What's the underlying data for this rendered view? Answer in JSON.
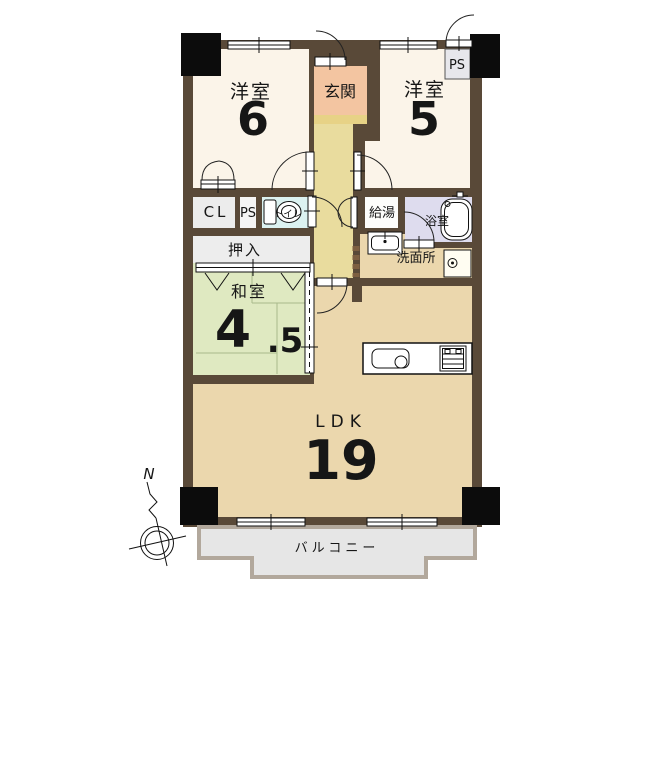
{
  "rooms": {
    "western6": {
      "name": "洋室",
      "size": "6"
    },
    "entrance": {
      "name": "玄関"
    },
    "western5": {
      "name": "洋室",
      "size": "5"
    },
    "ps_top": {
      "name": "PS"
    },
    "closet_cl": {
      "name": "CL"
    },
    "ps_mid": {
      "name": "PS"
    },
    "toilet": {
      "name": "トイレ"
    },
    "water_heater": {
      "name": "給湯"
    },
    "bathroom": {
      "name": "浴室"
    },
    "washroom": {
      "name": "洗面所"
    },
    "oshiire": {
      "name": "押入"
    },
    "japanese": {
      "name": "和室",
      "size_int": "4",
      "size_dec": ".5"
    },
    "ldk": {
      "name": "LDK",
      "size": "19"
    },
    "balcony": {
      "name": "バルコニー"
    }
  },
  "compass": {
    "north": "N"
  },
  "colors": {
    "wall": "#594938",
    "pillar": "#0c0c0c",
    "western_room": "#fbf4e9",
    "entrance": "#f3c5a1",
    "entrance_step": "#e7d286",
    "hallway": "#e9dc9e",
    "toilet": "#dcf2f1",
    "closet": "#ececec",
    "water_heater": "#fdfdfb",
    "bathroom": "#dedcee",
    "tatami": "#dfe9c1",
    "ldk": "#ebd7ad",
    "washer_pan": "#fffdf2",
    "balcony_fill": "#e6e6e6",
    "balcony_border": "#b2a89c"
  }
}
